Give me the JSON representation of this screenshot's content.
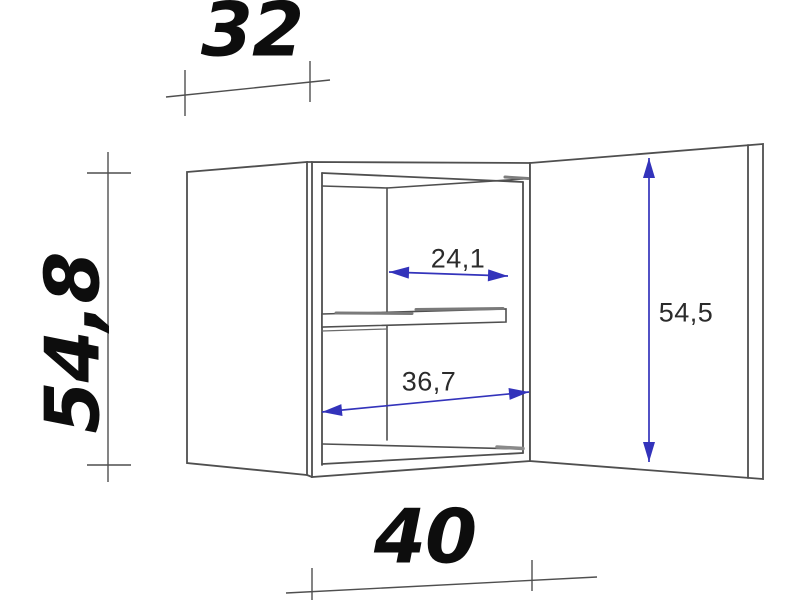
{
  "diagram": {
    "kind": "wall-cabinet-dimension-drawing",
    "labels": {
      "depth": "32",
      "height": "54,8",
      "width": "40",
      "inner_width_top": "24,1",
      "inner_width_bottom": "36,7",
      "door_height": "54,5"
    },
    "colors": {
      "background": "#ffffff",
      "drawing_line": "#4f4f4f",
      "dimension_arrow_blue": "#3333bb",
      "big_number_text": "#0d0d0d",
      "small_number_text": "#2b2b2b"
    }
  }
}
